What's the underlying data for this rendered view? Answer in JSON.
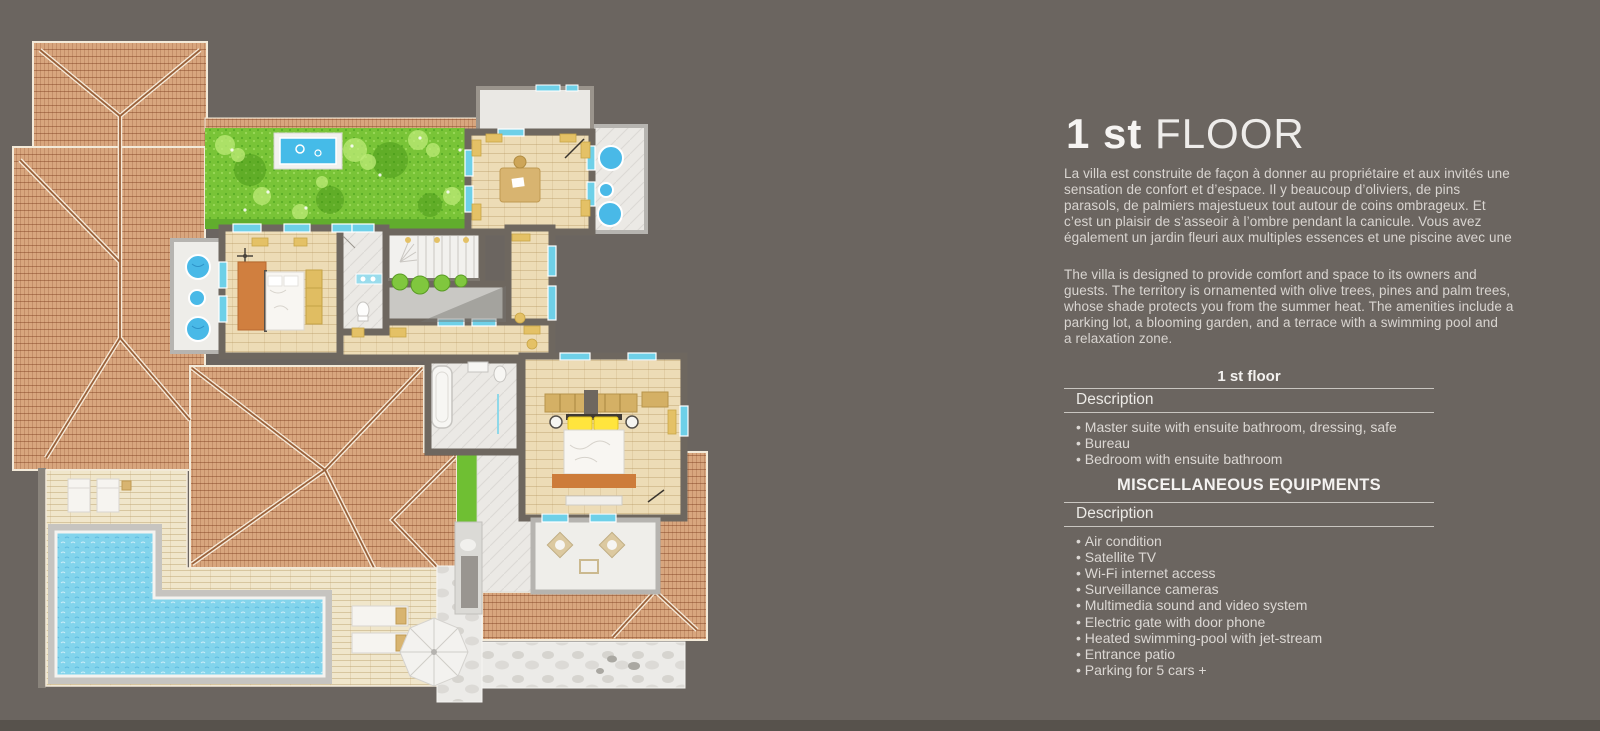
{
  "page": {
    "background_color": "#6b6560",
    "bottom_strip_color": "#57524c"
  },
  "panel": {
    "title": {
      "number": "1 st",
      "rest": "FLOOR"
    },
    "paragraph_fr": "La villa est construite de façon à donner au propriétaire et aux invités une\nsensation de confort et d’espace. Il y beaucoup d’oliviers, de pins\nparasols, de palmiers majestueux tout autour de coins ombrageux. Et\nc’est un plaisir de s’asseoir à l’ombre pendant la canicule. Vous avez\négalement un jardin fleuri aux multiples essences et une piscine avec une",
    "paragraph_en": "The villa is designed to provide comfort and space to its owners and\nguests. The territory is ornamented with olive trees, pines and palm trees,\nwhose shade protects you from the summer heat. The amenities include a\nparking lot, a blooming garden, and a terrace with a swimming pool and\na relaxation zone.",
    "floor_caption": "1 st floor",
    "description_label_1": "Description",
    "floor_items": [
      "Master suite with ensuite bathroom, dressing, safe",
      "Bureau",
      "Bedroom with ensuite bathroom"
    ],
    "equipment_title": "MISCELLANEOUS EQUIPMENTS",
    "description_label_2": "Description",
    "equipment_items": [
      "Air condition",
      "Satellite TV",
      "Wi-Fi internet access",
      "Surveillance cameras",
      "Multimedia sound and video system",
      "Electric gate with door phone",
      "Heated swimming-pool with jet-stream",
      "Entrance patio",
      "Parking for 5 cars +"
    ]
  },
  "floorplan": {
    "colors": {
      "roof_tile": "#d8a67e",
      "roof_ridge": "#99613a",
      "grass": "#79c437",
      "hedge": "#61ad2d",
      "pool_water": "#82d4ec",
      "garden_pool_water": "#45bbe8",
      "wood_floor": "#eddcb6",
      "deck": "#f0e6cb",
      "marble": "#ebe9e5",
      "stone_path": "#ecebe8",
      "wall": "#6e675f",
      "furniture_accent": "#d8b470",
      "spa_blue": "#49b9e7",
      "window_blue": "#6ed0e8",
      "bed_orange": "#d07f3f",
      "pillow_yellow": "#ffe53d"
    }
  }
}
